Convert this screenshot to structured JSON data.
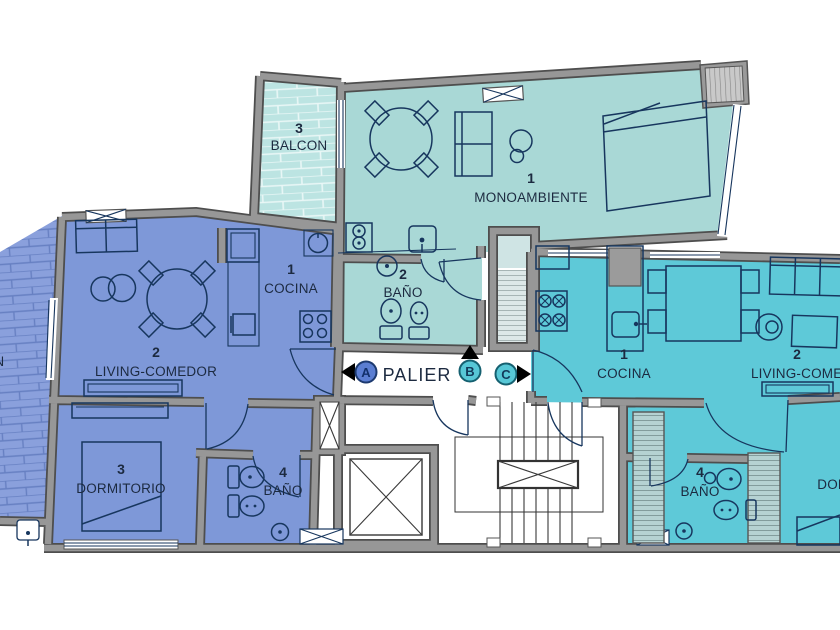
{
  "palier": {
    "label": "PALIER",
    "markers": [
      {
        "letter": "A",
        "fill": "#5b7ed2"
      },
      {
        "letter": "B",
        "fill": "#57c7d6"
      },
      {
        "letter": "C",
        "fill": "#57c7d6"
      }
    ]
  },
  "unit_mono": {
    "balcony_number": "3",
    "balcony_label": "BALCON",
    "main_number": "1",
    "main_label": "MONOAMBIENTE",
    "bath_number": "2",
    "bath_label": "BAÑO"
  },
  "unit_left": {
    "balcony_label": "BALCON",
    "cocina_number": "1",
    "cocina_label": "COCINA",
    "living_number": "2",
    "living_label": "LIVING-COMEDOR",
    "dorm_number": "3",
    "dorm_label": "DORMITORIO",
    "bath_number": "4",
    "bath_label": "BAÑO"
  },
  "unit_right": {
    "cocina_number": "1",
    "cocina_label": "COCINA",
    "living_number": "2",
    "living_label": "LIVING-COMEDOR",
    "bath_number": "4",
    "bath_label": "BAÑO",
    "dorm_label": "DORMITORIO"
  },
  "colors": {
    "teal_unit": "#a9d8d6",
    "teal_balcony": "#bce4e2",
    "blue_unit": "#7e98d8",
    "blue_balcony": "#8aa0dc",
    "cyan_unit": "#5ec9d8",
    "wall_gray": "#979797",
    "line_navy": "#17365e",
    "text": "#1c2a40"
  }
}
